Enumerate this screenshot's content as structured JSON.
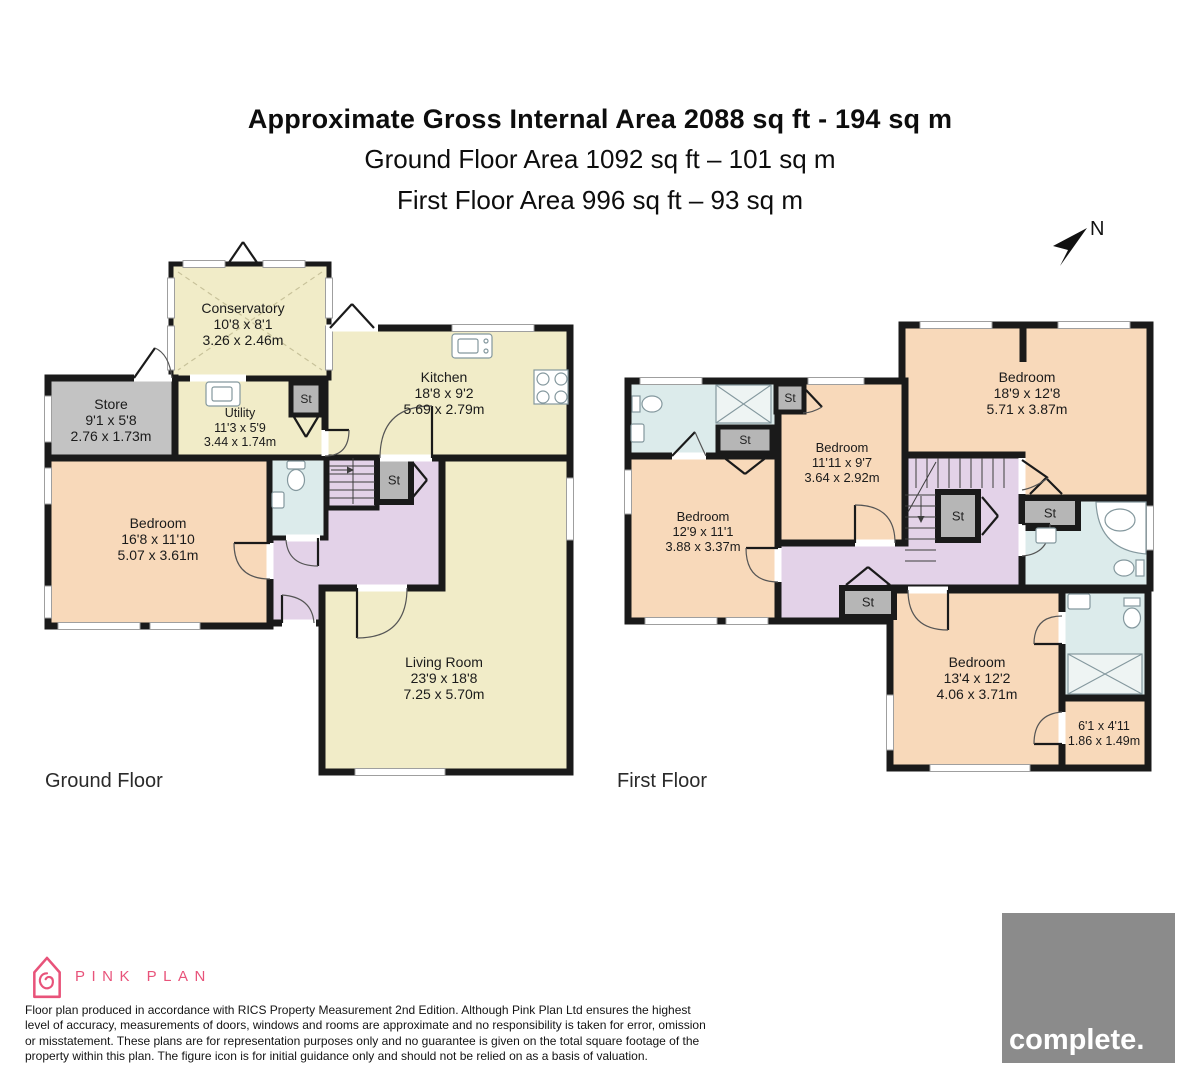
{
  "title": {
    "line1": "Approximate Gross Internal Area 2088 sq ft - 194 sq m",
    "line2": "Ground Floor Area 1092 sq ft – 101 sq m",
    "line3": "First Floor Area 996 sq ft – 93 sq m"
  },
  "compass_label": "N",
  "closet_label": "St",
  "ground": {
    "floor_label": "Ground Floor",
    "conservatory": {
      "name": "Conservatory",
      "imperial": "10'8 x 8'1",
      "metric": "3.26 x 2.46m"
    },
    "store": {
      "name": "Store",
      "imperial": "9'1 x 5'8",
      "metric": "2.76 x 1.73m"
    },
    "utility": {
      "name": "Utility",
      "imperial": "11'3 x 5'9",
      "metric": "3.44 x 1.74m"
    },
    "kitchen": {
      "name": "Kitchen",
      "imperial": "18'8 x 9'2",
      "metric": "5.69 x 2.79m"
    },
    "bedroom": {
      "name": "Bedroom",
      "imperial": "16'8 x 11'10",
      "metric": "5.07 x 3.61m"
    },
    "living": {
      "name": "Living Room",
      "imperial": "23'9 x 18'8",
      "metric": "7.25 x 5.70m"
    }
  },
  "first": {
    "floor_label": "First Floor",
    "bedroom1": {
      "name": "Bedroom",
      "imperial": "18'9 x 12'8",
      "metric": "5.71 x 3.87m"
    },
    "bedroom2": {
      "name": "Bedroom",
      "imperial": "11'11 x 9'7",
      "metric": "3.64 x 2.92m"
    },
    "bedroom3": {
      "name": "Bedroom",
      "imperial": "12'9 x 11'1",
      "metric": "3.88 x 3.37m"
    },
    "bedroom4": {
      "name": "Bedroom",
      "imperial": "13'4 x 12'2",
      "metric": "4.06 x 3.71m"
    },
    "room_small": {
      "imperial": "6'1 x 4'11",
      "metric": "1.86 x 1.49m"
    }
  },
  "footer": {
    "brand_name": "PINK PLAN",
    "disclaimer": "Floor plan produced in accordance with RICS Property Measurement 2nd Edition. Although Pink Plan Ltd ensures the highest level of accuracy, measurements of doors, windows and rooms are approximate and no responsibility is taken for error, omission or misstatement. These plans are for representation purposes only and no guarantee is given on the total square footage of the property within this plan. The figure icon is for initial guidance only and should not be relied on as a basis of valuation.",
    "agency_logo": "complete."
  },
  "colors": {
    "wall": "#1a1a1a",
    "room_yellow": "#f1ecc8",
    "room_peach": "#f8d9ba",
    "room_purple": "#e3d2e8",
    "room_blue": "#dcebeb",
    "room_gray": "#c3c3c3",
    "closet_gray": "#b6b6b6",
    "brand_pink": "#e8537a",
    "logo_gray": "#8b8b8b"
  }
}
